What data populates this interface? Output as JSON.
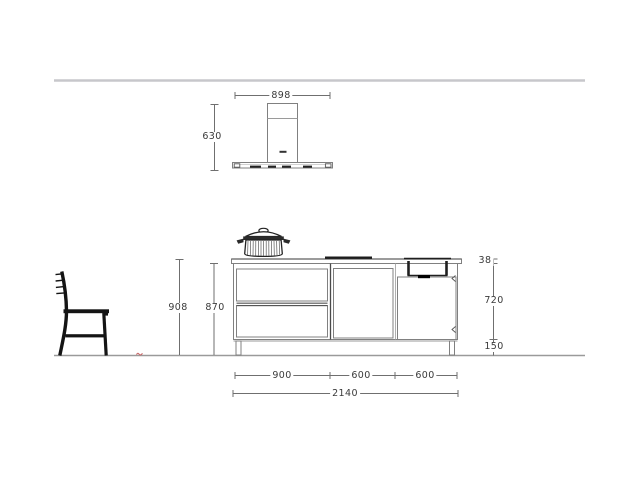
{
  "drawing": {
    "title": "kitchen-island-elevation-drawing",
    "labels": {
      "hood_width": "898",
      "hood_height": "630",
      "worktop_height": "908",
      "cabinet_with_plinth_height": "870",
      "worktop_thickness": "38",
      "carcass_height": "720",
      "plinth_height": "150",
      "segment_left": "900",
      "segment_middle": "600",
      "segment_right": "600",
      "total_width": "2140"
    },
    "colors": {
      "outline_gray": "#808080",
      "dark_detail": "#1f1f1f",
      "dimension_line": "#6f6f6f",
      "dimension_text": "#3a3a3a",
      "ceiling_line": "#c7c7cb",
      "floor_line": "#9a9a9a",
      "accent_red": "#c96a6a"
    },
    "objects": [
      "ceiling line",
      "cooker hood with chimney and control strip",
      "cooking pot with lid",
      "induction hob",
      "kitchen island with two drawers and two doors",
      "undermount sink with drain",
      "bar stool",
      "floor line",
      "small red floor mark"
    ]
  }
}
